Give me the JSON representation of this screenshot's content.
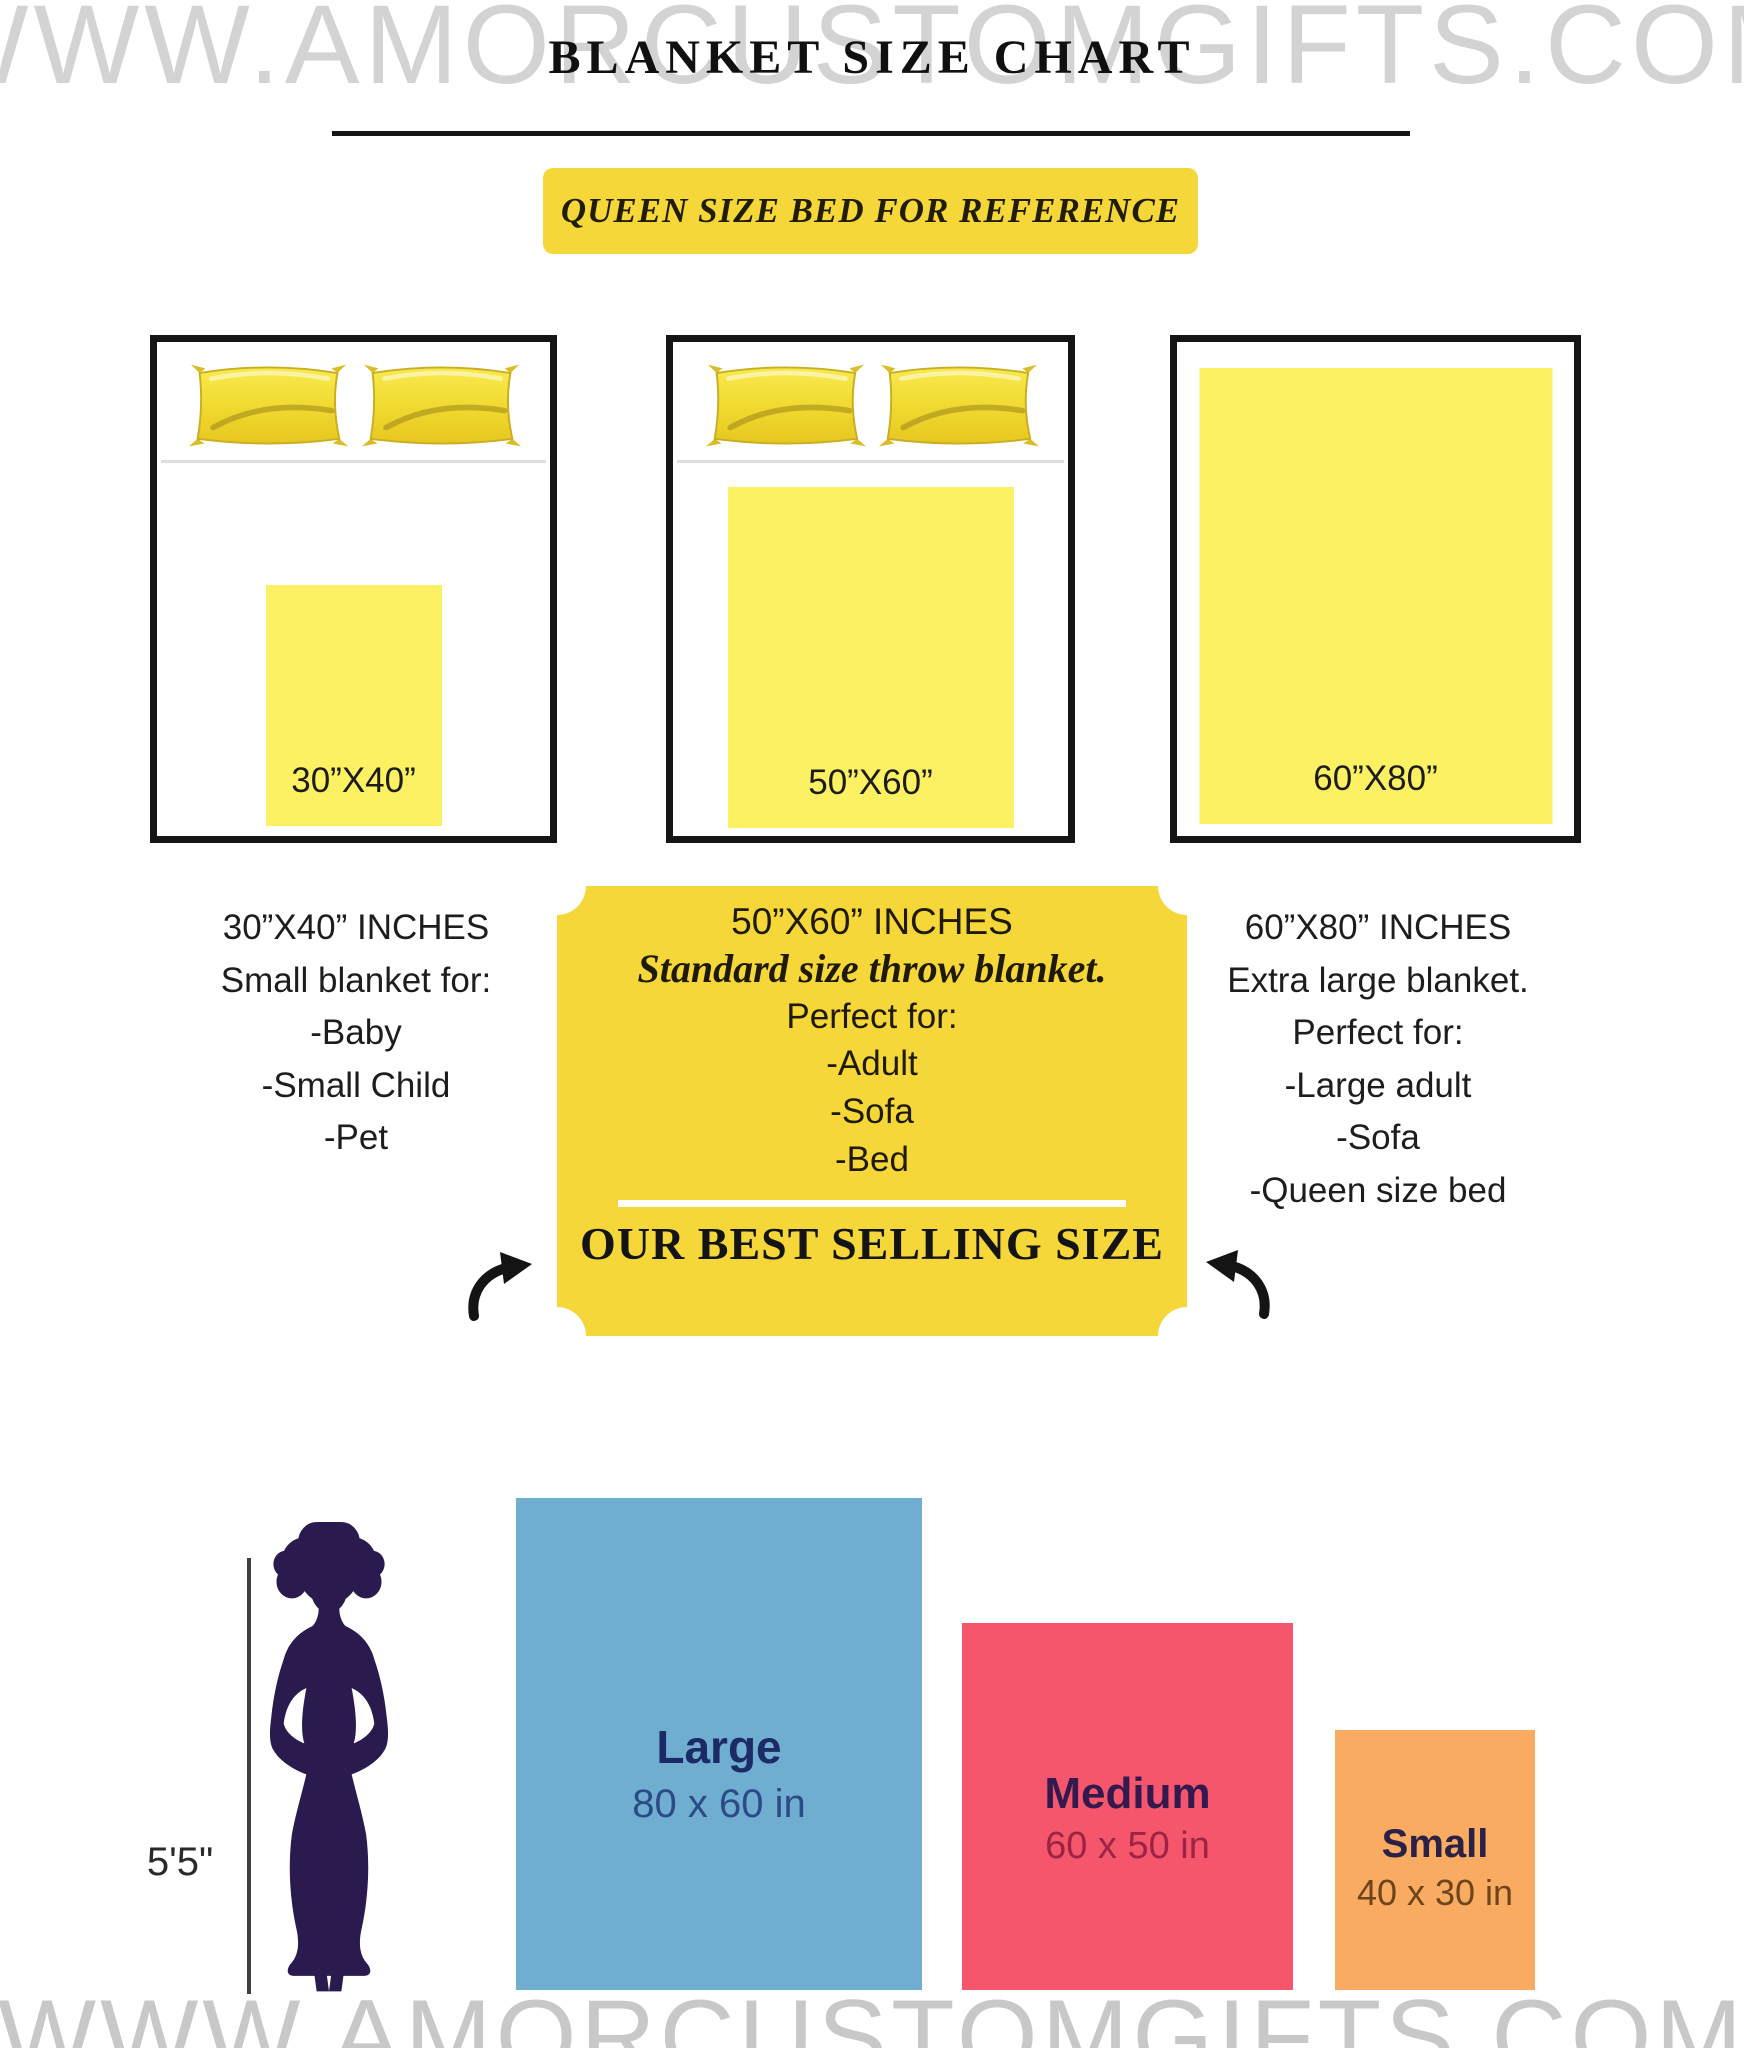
{
  "watermark": {
    "text": "WWW.AMORCUSTOMGIFTS.COM"
  },
  "header": {
    "title": "BLANKET SIZE CHART",
    "banner": "QUEEN SIZE BED FOR REFERENCE"
  },
  "beds": [
    {
      "blanket_label": "30”X40”",
      "has_pillows": true
    },
    {
      "blanket_label": "50”X60”",
      "has_pillows": true
    },
    {
      "blanket_label": "60”X80”",
      "has_pillows": false
    }
  ],
  "size_columns": {
    "left": {
      "lines": [
        "30”X40” INCHES",
        "Small blanket for:",
        "-Baby",
        "-Small Child",
        "-Pet"
      ]
    },
    "center": {
      "title": "50”X60” INCHES",
      "subtitle": "Standard size throw blanket.",
      "perfect_for": "Perfect for:",
      "items": [
        "-Adult",
        "-Sofa",
        "-Bed"
      ],
      "footer": "OUR BEST SELLING SIZE"
    },
    "right": {
      "lines": [
        "60”X80” INCHES",
        "Extra large blanket.",
        "Perfect for:",
        "-Large adult",
        "-Sofa",
        "-Queen size bed"
      ]
    }
  },
  "comparison": {
    "height_label": "5'5\"",
    "bars": [
      {
        "name": "Large",
        "dims": "80 x 60 in",
        "color": "#70aed1"
      },
      {
        "name": "Medium",
        "dims": "60 x 50 in",
        "color": "#f6566c"
      },
      {
        "name": "Small",
        "dims": "40 x 30 in",
        "color": "#f9ab62"
      }
    ]
  },
  "colors": {
    "accent_yellow": "#f5d73a",
    "blanket_yellow": "#fbf163",
    "bed_border": "#151515",
    "silhouette": "#2a1a4e",
    "watermark_gray": "#d3d3d3",
    "bar_blue": "#70aed1",
    "bar_pink": "#f6566c",
    "bar_orange": "#f9ab62"
  }
}
